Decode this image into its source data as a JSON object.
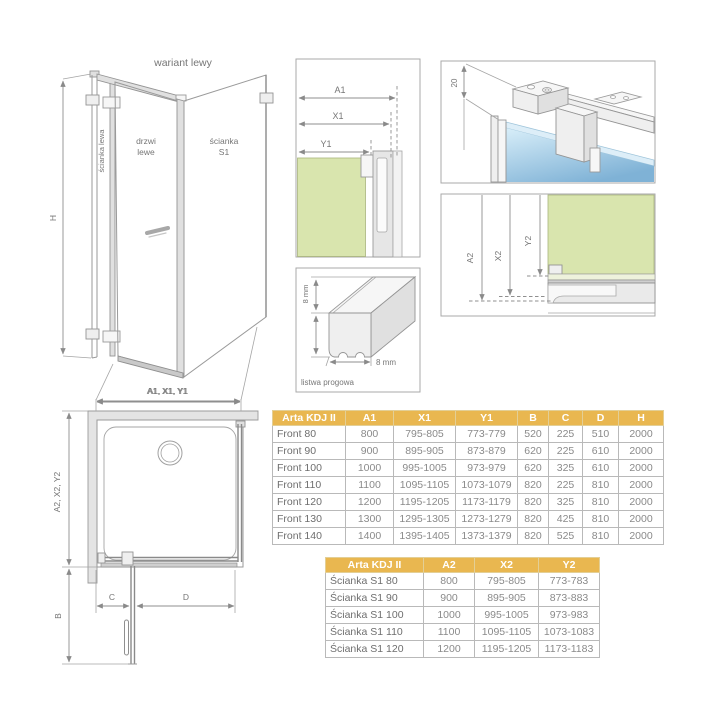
{
  "colors": {
    "accent_gold": "#e9b750",
    "glass_green": "#d9e5ae",
    "glass_blue": "#8fbcda",
    "line_gray": "#9a9a9a"
  },
  "iso_view": {
    "title": "wariant lewy",
    "side_panel_label": "ścianka lewa",
    "door_label_line1": "drzwi",
    "door_label_line2": "lewe",
    "s1_label_line1": "ścianka",
    "s1_label_line2": "S1",
    "height_dim": "H",
    "width_dim": "A1, X1, Y1"
  },
  "detail_top": {
    "dim_a1": "A1",
    "dim_x1": "X1",
    "dim_y1": "Y1"
  },
  "detail_hanger": {
    "dim_20": "20"
  },
  "detail_side": {
    "dim_a2": "A2",
    "dim_x2": "X2",
    "dim_y2": "Y2"
  },
  "detail_threshold": {
    "dim_height": "8 mm",
    "dim_width": "8 mm",
    "caption": "listwa progowa"
  },
  "plan_view": {
    "width_dim": "A1, X1, Y1",
    "depth_dim": "A2, X2, Y2",
    "dim_b": "B",
    "dim_c": "C",
    "dim_d": "D"
  },
  "front_table": {
    "headers": [
      "Arta KDJ II",
      "A1",
      "X1",
      "Y1",
      "B",
      "C",
      "D",
      "H"
    ],
    "rows": [
      [
        "Front 80",
        "800",
        "795-805",
        "773-779",
        "520",
        "225",
        "510",
        "2000"
      ],
      [
        "Front 90",
        "900",
        "895-905",
        "873-879",
        "620",
        "225",
        "610",
        "2000"
      ],
      [
        "Front 100",
        "1000",
        "995-1005",
        "973-979",
        "620",
        "325",
        "610",
        "2000"
      ],
      [
        "Front 110",
        "1100",
        "1095-1105",
        "1073-1079",
        "820",
        "225",
        "810",
        "2000"
      ],
      [
        "Front 120",
        "1200",
        "1195-1205",
        "1173-1179",
        "820",
        "325",
        "810",
        "2000"
      ],
      [
        "Front 130",
        "1300",
        "1295-1305",
        "1273-1279",
        "820",
        "425",
        "810",
        "2000"
      ],
      [
        "Front 140",
        "1400",
        "1395-1405",
        "1373-1379",
        "820",
        "525",
        "810",
        "2000"
      ]
    ]
  },
  "s1_table": {
    "headers": [
      "Arta KDJ II",
      "A2",
      "X2",
      "Y2"
    ],
    "rows": [
      [
        "Ścianka S1 80",
        "800",
        "795-805",
        "773-783"
      ],
      [
        "Ścianka S1 90",
        "900",
        "895-905",
        "873-883"
      ],
      [
        "Ścianka S1 100",
        "1000",
        "995-1005",
        "973-983"
      ],
      [
        "Ścianka S1 110",
        "1100",
        "1095-1105",
        "1073-1083"
      ],
      [
        "Ścianka S1 120",
        "1200",
        "1195-1205",
        "1173-1183"
      ]
    ]
  }
}
